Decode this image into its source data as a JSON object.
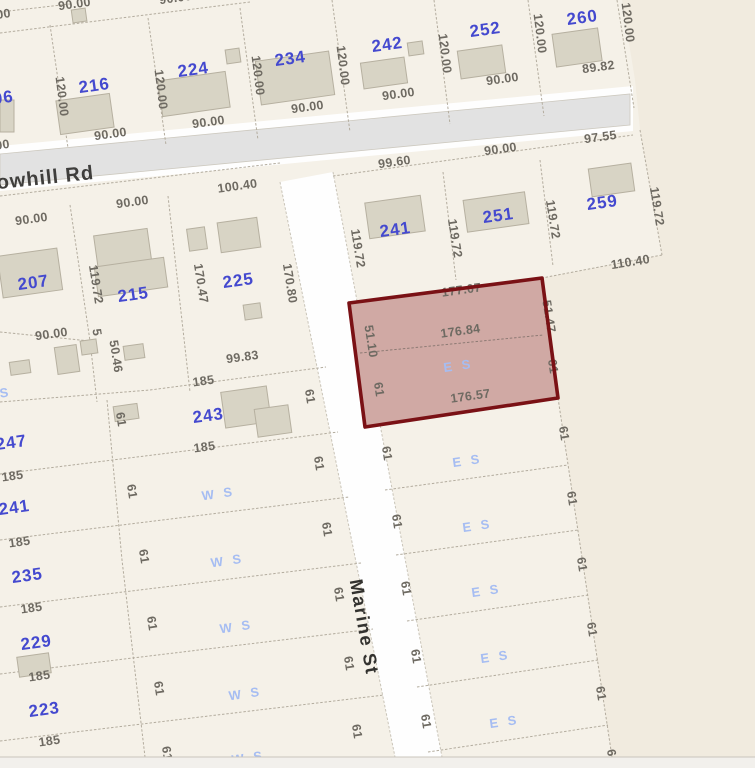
{
  "map": {
    "street_labels": [
      {
        "t": "owhill Rd",
        "x": 46,
        "y": 184,
        "r": -6,
        "cls": "street-rd"
      },
      {
        "t": "Marine St",
        "x": 358,
        "y": 628,
        "r": 80,
        "cls": "street-marine"
      }
    ],
    "highlighted_parcel": {
      "top_dim": "177.07",
      "middle_dim": "176.84",
      "bottom_dim": "176.57",
      "left_upper_dim": "51.10",
      "left_lower_dim": "61",
      "right_upper_dim": "51.47",
      "right_lower_dim": "61",
      "row_label": "E S"
    },
    "parcel_numbers": [
      {
        "t": "96",
        "x": 4,
        "y": 103
      },
      {
        "t": "216",
        "x": 95,
        "y": 91
      },
      {
        "t": "224",
        "x": 194,
        "y": 75
      },
      {
        "t": "234",
        "x": 291,
        "y": 64
      },
      {
        "t": "242",
        "x": 388,
        "y": 50
      },
      {
        "t": "252",
        "x": 486,
        "y": 35
      },
      {
        "t": "260",
        "x": 583,
        "y": 23
      },
      {
        "t": "207",
        "x": 34,
        "y": 288
      },
      {
        "t": "215",
        "x": 134,
        "y": 300
      },
      {
        "t": "225",
        "x": 239,
        "y": 286
      },
      {
        "t": "241",
        "x": 396,
        "y": 235
      },
      {
        "t": "251",
        "x": 499,
        "y": 221
      },
      {
        "t": "259",
        "x": 603,
        "y": 208
      },
      {
        "t": "247",
        "x": 12,
        "y": 448
      },
      {
        "t": "243",
        "x": 209,
        "y": 421
      },
      {
        "t": "241",
        "x": 15,
        "y": 513
      },
      {
        "t": "235",
        "x": 28,
        "y": 581
      },
      {
        "t": "229",
        "x": 37,
        "y": 648
      },
      {
        "t": "223",
        "x": 45,
        "y": 715
      }
    ],
    "row_labels": [
      {
        "t": "E S",
        "x": 468,
        "y": 465
      },
      {
        "t": "E S",
        "x": 478,
        "y": 530
      },
      {
        "t": "E S",
        "x": 487,
        "y": 595
      },
      {
        "t": "E S",
        "x": 496,
        "y": 661
      },
      {
        "t": "E S",
        "x": 505,
        "y": 726
      },
      {
        "t": "W S",
        "x": 219,
        "y": 498
      },
      {
        "t": "W S",
        "x": 228,
        "y": 565
      },
      {
        "t": "W S",
        "x": 237,
        "y": 631
      },
      {
        "t": "W S",
        "x": 246,
        "y": 698
      },
      {
        "t": "W S",
        "x": 249,
        "y": 762
      },
      {
        "t": "S",
        "x": 6,
        "y": 397
      }
    ],
    "dimension_labels": [
      {
        "t": "90.00",
        "x": 75,
        "y": 8,
        "r": -8
      },
      {
        "t": "00",
        "x": 4,
        "y": 18,
        "r": -8
      },
      {
        "t": "90.00",
        "x": 176,
        "y": 2,
        "r": -8
      },
      {
        "t": "90.00",
        "x": -6,
        "y": 150,
        "r": -8
      },
      {
        "t": "120.00",
        "x": 58,
        "y": 97,
        "r": 83
      },
      {
        "t": "90.00",
        "x": 111,
        "y": 138,
        "r": -8
      },
      {
        "t": "120.00",
        "x": 157,
        "y": 90,
        "r": 83
      },
      {
        "t": "90.00",
        "x": 209,
        "y": 126,
        "r": -8
      },
      {
        "t": "120.00",
        "x": 254,
        "y": 76,
        "r": 83
      },
      {
        "t": "90.00",
        "x": 308,
        "y": 111,
        "r": -8
      },
      {
        "t": "120.00",
        "x": 339,
        "y": 66,
        "r": 83
      },
      {
        "t": "90.00",
        "x": 399,
        "y": 98,
        "r": -8
      },
      {
        "t": "120.00",
        "x": 441,
        "y": 54,
        "r": 83
      },
      {
        "t": "90.00",
        "x": 503,
        "y": 83,
        "r": -8
      },
      {
        "t": "120.00",
        "x": 536,
        "y": 34,
        "r": 83
      },
      {
        "t": "89.82",
        "x": 599,
        "y": 71,
        "r": -8
      },
      {
        "t": "120.00",
        "x": 624,
        "y": 23,
        "r": 83
      },
      {
        "t": "97.55",
        "x": 601,
        "y": 141,
        "r": -8
      },
      {
        "t": "90.00",
        "x": 501,
        "y": 153,
        "r": -8
      },
      {
        "t": "99.60",
        "x": 395,
        "y": 166,
        "r": -8
      },
      {
        "t": "100.40",
        "x": 238,
        "y": 190,
        "r": -8
      },
      {
        "t": "90.00",
        "x": 133,
        "y": 206,
        "r": -8
      },
      {
        "t": "90.00",
        "x": 32,
        "y": 223,
        "r": -8
      },
      {
        "t": "119.72",
        "x": 92,
        "y": 285,
        "r": 81
      },
      {
        "t": "170.47",
        "x": 197,
        "y": 284,
        "r": 81
      },
      {
        "t": "170.80",
        "x": 286,
        "y": 284,
        "r": 81
      },
      {
        "t": "90.00",
        "x": 52,
        "y": 338,
        "r": -8
      },
      {
        "t": "5",
        "x": 93,
        "y": 333,
        "r": 81,
        "s": 10
      },
      {
        "t": "50.46",
        "x": 112,
        "y": 357,
        "r": 81
      },
      {
        "t": "99.83",
        "x": 243,
        "y": 361,
        "r": -8
      },
      {
        "t": "185",
        "x": 204,
        "y": 385,
        "r": -8
      },
      {
        "t": "61",
        "x": 117,
        "y": 420,
        "r": 81
      },
      {
        "t": "61",
        "x": 306,
        "y": 397,
        "r": 81
      },
      {
        "t": "185",
        "x": 205,
        "y": 451,
        "r": -8
      },
      {
        "t": "185",
        "x": 13,
        "y": 480,
        "r": -8
      },
      {
        "t": "61",
        "x": 315,
        "y": 464,
        "r": 81
      },
      {
        "t": "61",
        "x": 128,
        "y": 492,
        "r": 81
      },
      {
        "t": "185",
        "x": 20,
        "y": 546,
        "r": -8
      },
      {
        "t": "61",
        "x": 323,
        "y": 530,
        "r": 81
      },
      {
        "t": "61",
        "x": 140,
        "y": 557,
        "r": 81
      },
      {
        "t": "185",
        "x": 32,
        "y": 612,
        "r": -8
      },
      {
        "t": "61",
        "x": 335,
        "y": 595,
        "r": 81
      },
      {
        "t": "61",
        "x": 148,
        "y": 624,
        "r": 81
      },
      {
        "t": "185",
        "x": 40,
        "y": 680,
        "r": -8
      },
      {
        "t": "61",
        "x": 345,
        "y": 664,
        "r": 81
      },
      {
        "t": "61",
        "x": 155,
        "y": 689,
        "r": 81
      },
      {
        "t": "185",
        "x": 50,
        "y": 745,
        "r": -8
      },
      {
        "t": "61",
        "x": 353,
        "y": 732,
        "r": 81
      },
      {
        "t": "61",
        "x": 163,
        "y": 754,
        "r": 81
      },
      {
        "t": "119.72",
        "x": 354,
        "y": 249,
        "r": 81
      },
      {
        "t": "119.72",
        "x": 451,
        "y": 239,
        "r": 81
      },
      {
        "t": "119.72",
        "x": 549,
        "y": 220,
        "r": 81
      },
      {
        "t": "119.72",
        "x": 653,
        "y": 207,
        "r": 81
      },
      {
        "t": "110.40",
        "x": 631,
        "y": 266,
        "r": -9
      },
      {
        "t": "61",
        "x": 383,
        "y": 454,
        "r": 81
      },
      {
        "t": "61",
        "x": 560,
        "y": 434,
        "r": 81
      },
      {
        "t": "61",
        "x": 393,
        "y": 522,
        "r": 81
      },
      {
        "t": "61",
        "x": 568,
        "y": 499,
        "r": 81
      },
      {
        "t": "61",
        "x": 402,
        "y": 589,
        "r": 81
      },
      {
        "t": "61",
        "x": 578,
        "y": 565,
        "r": 81
      },
      {
        "t": "61",
        "x": 412,
        "y": 657,
        "r": 81
      },
      {
        "t": "61",
        "x": 588,
        "y": 630,
        "r": 81
      },
      {
        "t": "61",
        "x": 422,
        "y": 722,
        "r": 81
      },
      {
        "t": "61",
        "x": 597,
        "y": 694,
        "r": 81
      },
      {
        "t": "61",
        "x": 608,
        "y": 757,
        "r": 81
      }
    ],
    "colors": {
      "parcel_area": "#f5f1e8",
      "outside": "#f1ebdf",
      "road_fill": "#e2e2e2",
      "road_casing": "#fefefe",
      "lot_line": "#b3ac9e",
      "building_fill": "#d8d4c5",
      "building_stroke": "#b6b0a0",
      "highlight_fill": "#d0a9a4",
      "highlight_stroke": "#7a1115",
      "dimension_text": "#6e6a62",
      "parcel_number_text": "#4449cf",
      "row_label_text": "#a6bdf2",
      "street_text": "#3f3e3c"
    }
  }
}
